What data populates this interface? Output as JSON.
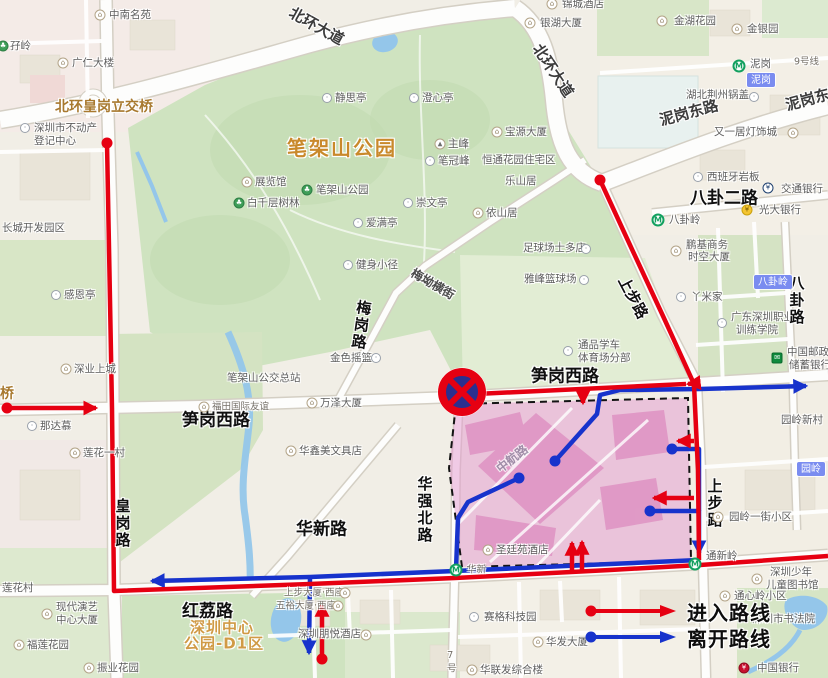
{
  "colors": {
    "bg": "#f1eee6",
    "enter": "#e60012",
    "leave": "#1733cc",
    "zone": "#e59cd0",
    "zoneInner": "#d468ae",
    "signBlue": "#2b2f8f",
    "park": "#cfe3c0",
    "parkDark": "#c2dab0",
    "courts": "#e2edd4",
    "water": "#94c6ea",
    "roadCase": "#d4cfc4",
    "badge": "#7a8cf0"
  },
  "legend": {
    "enter_label": "进入路线",
    "leave_label": "离开路线"
  },
  "badges": [
    {
      "t": "泥岗",
      "x": 747,
      "y": 80
    },
    {
      "t": "八卦岭",
      "x": 754,
      "y": 282
    },
    {
      "t": "园岭",
      "x": 797,
      "y": 469
    }
  ],
  "labels": [
    {
      "t": "中南名苑",
      "x": 109,
      "y": 15,
      "c": "p"
    },
    {
      "t": "孖岭",
      "x": 10,
      "y": 46,
      "c": "p"
    },
    {
      "t": "广仁大楼",
      "x": 72,
      "y": 63,
      "c": "p"
    },
    {
      "t": "北环皇岗立交桥",
      "x": 55,
      "y": 107,
      "c": "ab"
    },
    {
      "t": "深圳市不动产",
      "x": 34,
      "y": 128,
      "c": "p"
    },
    {
      "t": "登记中心",
      "x": 34,
      "y": 141,
      "c": "p"
    },
    {
      "t": "长城开发园区",
      "x": 2,
      "y": 228,
      "c": "p"
    },
    {
      "t": "展览馆",
      "x": 255,
      "y": 182,
      "c": "p"
    },
    {
      "t": "白千层树林",
      "x": 247,
      "y": 203,
      "c": "p"
    },
    {
      "t": "笔架山公园",
      "x": 287,
      "y": 148,
      "c": "pk"
    },
    {
      "t": "笔架山公园",
      "x": 316,
      "y": 190,
      "c": "p"
    },
    {
      "t": "静思亭",
      "x": 335,
      "y": 98,
      "c": "p"
    },
    {
      "t": "澄心亭",
      "x": 422,
      "y": 98,
      "c": "p"
    },
    {
      "t": "主峰",
      "x": 448,
      "y": 144,
      "c": "p"
    },
    {
      "t": "笔冠峰",
      "x": 438,
      "y": 161,
      "c": "p"
    },
    {
      "t": "宝源大厦",
      "x": 505,
      "y": 132,
      "c": "p"
    },
    {
      "t": "恒通花园住宅区",
      "x": 482,
      "y": 160,
      "c": "p"
    },
    {
      "t": "乐山居",
      "x": 505,
      "y": 181,
      "c": "p"
    },
    {
      "t": "依山居",
      "x": 486,
      "y": 213,
      "c": "p"
    },
    {
      "t": "崇文亭",
      "x": 416,
      "y": 203,
      "c": "p"
    },
    {
      "t": "爱满亭",
      "x": 366,
      "y": 223,
      "c": "p"
    },
    {
      "t": "健身小径",
      "x": 356,
      "y": 265,
      "c": "p"
    },
    {
      "t": "感恩亭",
      "x": 64,
      "y": 295,
      "c": "p"
    },
    {
      "t": "金色摇篮",
      "x": 330,
      "y": 358,
      "c": "p"
    },
    {
      "t": "笔架山公交总站",
      "x": 227,
      "y": 378,
      "c": "p"
    },
    {
      "t": "万泽大厦",
      "x": 320,
      "y": 403,
      "c": "p"
    },
    {
      "t": "深业上城",
      "x": 74,
      "y": 369,
      "c": "p"
    },
    {
      "t": "那达慕",
      "x": 40,
      "y": 426,
      "c": "p"
    },
    {
      "t": "莲花一村",
      "x": 83,
      "y": 453,
      "c": "p"
    },
    {
      "t": "桥",
      "x": 0,
      "y": 394,
      "c": "ab"
    },
    {
      "t": "福田国际友谊",
      "x": 212,
      "y": 407,
      "c": "sm"
    },
    {
      "t": "莲花村",
      "x": 2,
      "y": 588,
      "c": "p"
    },
    {
      "t": "现代演艺",
      "x": 56,
      "y": 607,
      "c": "p"
    },
    {
      "t": "中心大厦",
      "x": 56,
      "y": 620,
      "c": "p"
    },
    {
      "t": "福莲花园",
      "x": 27,
      "y": 645,
      "c": "p"
    },
    {
      "t": "振业花园",
      "x": 97,
      "y": 668,
      "c": "p"
    },
    {
      "t": "深圳中心",
      "x": 190,
      "y": 628,
      "c": "pk2"
    },
    {
      "t": "公园-D1区",
      "x": 184,
      "y": 644,
      "c": "pk2"
    },
    {
      "t": "上步大厦·西座",
      "x": 284,
      "y": 593,
      "c": "sm"
    },
    {
      "t": "五裕大厦·西座",
      "x": 276,
      "y": 606,
      "c": "sm"
    },
    {
      "t": "深圳朋悦酒店",
      "x": 298,
      "y": 634,
      "c": "p"
    },
    {
      "t": "赛格科技园",
      "x": 484,
      "y": 617,
      "c": "p"
    },
    {
      "t": "华联发综合楼",
      "x": 480,
      "y": 670,
      "c": "p"
    },
    {
      "t": "7号",
      "x": 450,
      "y": 650,
      "c": "sm",
      "v": 1
    },
    {
      "t": "华发大厦",
      "x": 546,
      "y": 642,
      "c": "p"
    },
    {
      "t": "中国银行",
      "x": 757,
      "y": 668,
      "c": "p"
    },
    {
      "t": "深圳少年",
      "x": 770,
      "y": 572,
      "c": "p"
    },
    {
      "t": "儿童图书馆",
      "x": 766,
      "y": 585,
      "c": "p"
    },
    {
      "t": "通心岭小区",
      "x": 734,
      "y": 596,
      "c": "p"
    },
    {
      "t": "深圳市书法院",
      "x": 752,
      "y": 619,
      "c": "p"
    },
    {
      "t": "园岭新村",
      "x": 781,
      "y": 420,
      "c": "p"
    },
    {
      "t": "园岭一街小区",
      "x": 729,
      "y": 517,
      "c": "p"
    },
    {
      "t": "通新岭",
      "x": 706,
      "y": 556,
      "c": "p"
    },
    {
      "t": "华新",
      "x": 467,
      "y": 570,
      "c": "sm"
    },
    {
      "t": "中国邮政",
      "x": 787,
      "y": 352,
      "c": "p"
    },
    {
      "t": "储蓄银行",
      "x": 789,
      "y": 365,
      "c": "p"
    },
    {
      "t": "广东深圳职业",
      "x": 731,
      "y": 317,
      "c": "p"
    },
    {
      "t": "训练学院",
      "x": 736,
      "y": 330,
      "c": "p"
    },
    {
      "t": "丫米家",
      "x": 691,
      "y": 297,
      "c": "p"
    },
    {
      "t": "鹏基商务",
      "x": 686,
      "y": 245,
      "c": "p"
    },
    {
      "t": "时空大厦",
      "x": 688,
      "y": 257,
      "c": "p"
    },
    {
      "t": "八卦岭",
      "x": 669,
      "y": 220,
      "c": "p"
    },
    {
      "t": "交通银行",
      "x": 781,
      "y": 189,
      "c": "p"
    },
    {
      "t": "光大银行",
      "x": 759,
      "y": 210,
      "c": "p"
    },
    {
      "t": "西班牙岩板",
      "x": 707,
      "y": 177,
      "c": "p"
    },
    {
      "t": "又一居灯饰城",
      "x": 714,
      "y": 132,
      "c": "p"
    },
    {
      "t": "湖北荆州锅盖",
      "x": 686,
      "y": 95,
      "c": "p"
    },
    {
      "t": "泥岗",
      "x": 750,
      "y": 64,
      "c": "p"
    },
    {
      "t": "9号线",
      "x": 794,
      "y": 62,
      "c": "sm"
    },
    {
      "t": "金银园",
      "x": 747,
      "y": 29,
      "c": "p"
    },
    {
      "t": "金湖花园",
      "x": 674,
      "y": 21,
      "c": "p"
    },
    {
      "t": "锦城酒店",
      "x": 562,
      "y": 4,
      "c": "p"
    },
    {
      "t": "银湖大厦",
      "x": 540,
      "y": 23,
      "c": "p"
    },
    {
      "t": "圣廷苑酒店",
      "x": 496,
      "y": 550,
      "c": "p"
    },
    {
      "t": "华鑫美文具店",
      "x": 299,
      "y": 451,
      "c": "p"
    },
    {
      "t": "足球场士多店",
      "x": 523,
      "y": 248,
      "c": "p"
    },
    {
      "t": "雅峰篮球场",
      "x": 524,
      "y": 279,
      "c": "p"
    },
    {
      "t": "通品学车",
      "x": 578,
      "y": 345,
      "c": "p"
    },
    {
      "t": "体育场分部",
      "x": 578,
      "y": 358,
      "c": "p"
    },
    {
      "t": "泥岗东路",
      "x": 660,
      "y": 121,
      "c": "rd",
      "r": -15
    },
    {
      "t": "泥岗东路",
      "x": 786,
      "y": 106,
      "c": "rd",
      "r": -15
    },
    {
      "t": "北环大道",
      "x": 290,
      "y": 12,
      "c": "rd",
      "r": 29
    },
    {
      "t": "北环大道",
      "x": 536,
      "y": 46,
      "c": "rd",
      "r": 56
    },
    {
      "t": "八卦二路",
      "x": 690,
      "y": 199,
      "c": "rb"
    },
    {
      "t": "上步路",
      "x": 622,
      "y": 278,
      "c": "rb2",
      "r": 62
    },
    {
      "t": "上步路",
      "x": 714,
      "y": 478,
      "c": "rb2",
      "v": 1
    },
    {
      "t": "八卦路",
      "x": 796,
      "y": 275,
      "c": "rb2",
      "v": 1
    },
    {
      "t": "笋岗西路",
      "x": 182,
      "y": 421,
      "c": "rb"
    },
    {
      "t": "笋岗西路",
      "x": 531,
      "y": 377,
      "c": "rb"
    },
    {
      "t": "红荔路",
      "x": 182,
      "y": 612,
      "c": "rb"
    },
    {
      "t": "华新路",
      "x": 296,
      "y": 530,
      "c": "rb"
    },
    {
      "t": "华强北路",
      "x": 424,
      "y": 476,
      "c": "rb2",
      "v": 1
    },
    {
      "t": "皇岗路",
      "x": 122,
      "y": 498,
      "c": "rb2",
      "v": 1
    },
    {
      "t": "梅岗路",
      "x": 364,
      "y": 300,
      "c": "rb2",
      "v": 1,
      "r": 8
    },
    {
      "t": "梅坳横街",
      "x": 412,
      "y": 272,
      "c": "smr",
      "r": 30
    },
    {
      "t": "中航路",
      "x": 498,
      "y": 470,
      "c": "smr2",
      "r": -38
    }
  ],
  "icons": [
    {
      "k": "b",
      "x": 100,
      "y": 15
    },
    {
      "k": "t",
      "x": 3,
      "y": 46
    },
    {
      "k": "b",
      "x": 63,
      "y": 63
    },
    {
      "k": "d",
      "x": 25,
      "y": 128
    },
    {
      "k": "b",
      "x": 247,
      "y": 182
    },
    {
      "k": "t",
      "x": 239,
      "y": 203
    },
    {
      "k": "t",
      "x": 307,
      "y": 190
    },
    {
      "k": "d",
      "x": 327,
      "y": 98
    },
    {
      "k": "d",
      "x": 414,
      "y": 98
    },
    {
      "k": "mt",
      "x": 440,
      "y": 144
    },
    {
      "k": "d",
      "x": 430,
      "y": 161
    },
    {
      "k": "b",
      "x": 497,
      "y": 132
    },
    {
      "k": "b",
      "x": 478,
      "y": 213
    },
    {
      "k": "d",
      "x": 408,
      "y": 203
    },
    {
      "k": "d",
      "x": 358,
      "y": 223
    },
    {
      "k": "d",
      "x": 348,
      "y": 265
    },
    {
      "k": "d",
      "x": 56,
      "y": 295
    },
    {
      "k": "d",
      "x": 376,
      "y": 358
    },
    {
      "k": "b",
      "x": 312,
      "y": 403
    },
    {
      "k": "b",
      "x": 66,
      "y": 369
    },
    {
      "k": "d",
      "x": 32,
      "y": 426
    },
    {
      "k": "b",
      "x": 75,
      "y": 453
    },
    {
      "k": "b",
      "x": 204,
      "y": 407
    },
    {
      "k": "b",
      "x": 47,
      "y": 614
    },
    {
      "k": "b",
      "x": 19,
      "y": 645
    },
    {
      "k": "b",
      "x": 89,
      "y": 668
    },
    {
      "k": "b",
      "x": 345,
      "y": 593
    },
    {
      "k": "b",
      "x": 338,
      "y": 606
    },
    {
      "k": "b",
      "x": 366,
      "y": 635
    },
    {
      "k": "d",
      "x": 474,
      "y": 617
    },
    {
      "k": "b",
      "x": 472,
      "y": 670
    },
    {
      "k": "b",
      "x": 538,
      "y": 642
    },
    {
      "k": "br",
      "x": 744,
      "y": 668
    },
    {
      "k": "b",
      "x": 757,
      "y": 579
    },
    {
      "k": "b",
      "x": 725,
      "y": 596
    },
    {
      "k": "b",
      "x": 718,
      "y": 517
    },
    {
      "k": "m",
      "x": 739,
      "y": 66
    },
    {
      "k": "m",
      "x": 658,
      "y": 220
    },
    {
      "k": "m",
      "x": 456,
      "y": 570
    },
    {
      "k": "m",
      "x": 695,
      "y": 564
    },
    {
      "k": "pg",
      "x": 777,
      "y": 358
    },
    {
      "k": "d",
      "x": 722,
      "y": 323
    },
    {
      "k": "d",
      "x": 681,
      "y": 297
    },
    {
      "k": "b",
      "x": 676,
      "y": 251
    },
    {
      "k": "bb",
      "x": 768,
      "y": 188
    },
    {
      "k": "by",
      "x": 747,
      "y": 210
    },
    {
      "k": "d",
      "x": 698,
      "y": 177
    },
    {
      "k": "b",
      "x": 793,
      "y": 133
    },
    {
      "k": "d",
      "x": 754,
      "y": 97
    },
    {
      "k": "b",
      "x": 662,
      "y": 21
    },
    {
      "k": "b",
      "x": 737,
      "y": 29
    },
    {
      "k": "b",
      "x": 552,
      "y": 4
    },
    {
      "k": "b",
      "x": 530,
      "y": 23
    },
    {
      "k": "b",
      "x": 488,
      "y": 550
    },
    {
      "k": "b",
      "x": 291,
      "y": 451
    },
    {
      "k": "d",
      "x": 586,
      "y": 249
    },
    {
      "k": "d",
      "x": 584,
      "y": 280
    },
    {
      "k": "d",
      "x": 568,
      "y": 351
    }
  ]
}
